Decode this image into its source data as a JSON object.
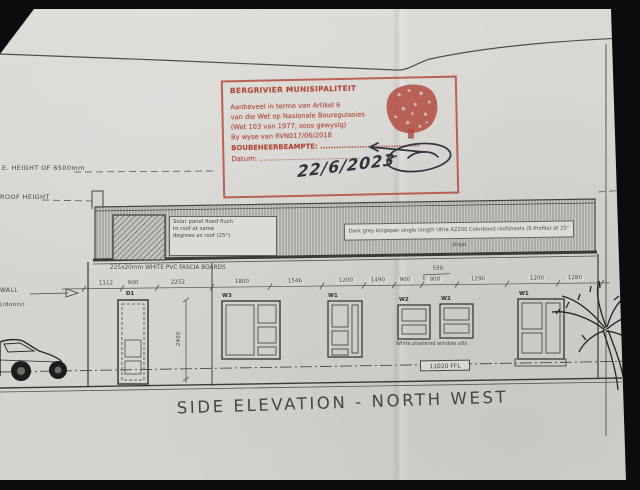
{
  "photo": {
    "background": "#0c0c0c",
    "paper_color": "#d6d5d1"
  },
  "stamp": {
    "color": "#b0473c",
    "municipality": "BERGRIVIER MUNISIPALITEIT",
    "lines": [
      "Aanbeveel in terme van Artikel 6",
      "van die Wet op Nasionale Bouregulasies",
      "(Wet 103 van 1977, soos gewysig)",
      "By wyse van RVN017/06/2018"
    ],
    "official_label": "BOUBEHEERBEAMPTE:",
    "official_dots": "......................................",
    "date_label": "Datum:",
    "date_dots": "..............................................",
    "handwritten_date": "22/6/2023"
  },
  "levels": {
    "ridge": "E. HEIGHT OF 6500mm",
    "roof": "ROOF HEIGHT",
    "wall": "WALL",
    "doors": "(/doors)"
  },
  "roof": {
    "solar_lines": [
      "Solar panel fixed flush",
      "to roof at same",
      "degrees as roof (25°)"
    ],
    "sheet_note": "Dark grey kingspan single length Ultra AZ200 Colorbond roofsheets (S-Profile) at 25° slope",
    "fascia_note": "225x20mm WHITE PVC FASCIA BOARDS"
  },
  "dimensions": {
    "values": [
      "1112",
      "900",
      "2252",
      "1800",
      "1546",
      "1200",
      "1490",
      "900",
      "900",
      "1290",
      "1200",
      "1280"
    ],
    "overhead": "530",
    "door_height": "2400"
  },
  "openings": {
    "d1": "D1",
    "w3": "W3",
    "w1a": "W1",
    "w2a": "W2",
    "w2b": "W2",
    "w1b": "W1",
    "sill_note": "White plastered window sills",
    "ffl": "11020 FFL"
  },
  "title": {
    "text": "SIDE ELEVATION - NORTH WEST"
  }
}
